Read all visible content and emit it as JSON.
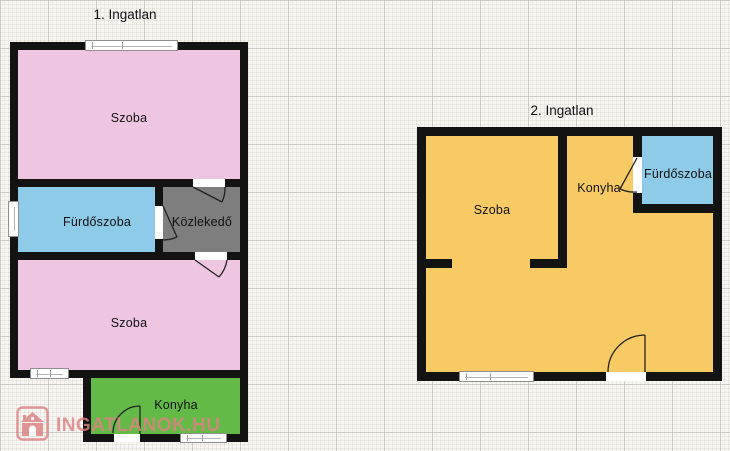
{
  "plans": [
    {
      "title": "1. Ingatlan",
      "rooms": [
        {
          "label": "Szoba",
          "color": "#eec6e1"
        },
        {
          "label": "Fürdőszoba",
          "color": "#8ecbe9"
        },
        {
          "label": "Közlekedő",
          "color": "#7e7e7e"
        },
        {
          "label": "Szoba",
          "color": "#eec6e1"
        },
        {
          "label": "Konyha",
          "color": "#63ba47"
        }
      ]
    },
    {
      "title": "2. Ingatlan",
      "rooms": [
        {
          "label": "Szoba",
          "color": "#f8ca63"
        },
        {
          "label": "Konyha",
          "color": "#f8ca63"
        },
        {
          "label": "Fürdőszoba",
          "color": "#8ecbe9"
        }
      ]
    }
  ],
  "wall_color": "#131313",
  "background_paper": "#f8f6f3",
  "watermark": {
    "text": "INGATLANOK.HU",
    "color": "#dd8181",
    "icon": "house-logo-icon"
  }
}
